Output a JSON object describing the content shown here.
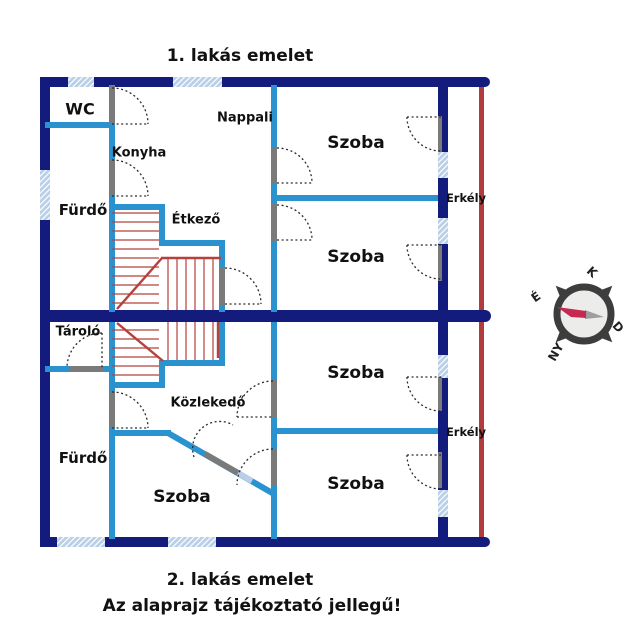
{
  "titles": {
    "top": "1. lakás emelet",
    "bottom": "2. lakás emelet",
    "note": "Az alaprajz tájékoztató jellegű!"
  },
  "floor1": {
    "wc": "WC",
    "konyha": "Konyha",
    "nappali": "Nappali",
    "szoba_felso": "Szoba",
    "szoba_also": "Szoba",
    "furdo": "Fürdő",
    "etkezo": "Étkező",
    "erkely": "Erkély"
  },
  "floor2": {
    "tarolo": "Tároló",
    "kozlekedo": "Közlekedő",
    "furdo": "Fürdő",
    "szoba_bal": "Szoba",
    "szoba_felso": "Szoba",
    "szoba_also": "Szoba",
    "erkely": "Erkély"
  },
  "compass": {
    "north": "É",
    "east": "K",
    "south": "D",
    "west": "NY"
  },
  "colors": {
    "wall": "#131b7c",
    "partition": "#2a93cf",
    "window": "#b9cfe8",
    "boundary": "#b03c3e",
    "stairs": "#b5413d",
    "door_jamb": "#7a7a7a",
    "compass_ring": "#3d3d3d",
    "needle_red": "#c62850",
    "needle_gray": "#9e9e9e"
  }
}
